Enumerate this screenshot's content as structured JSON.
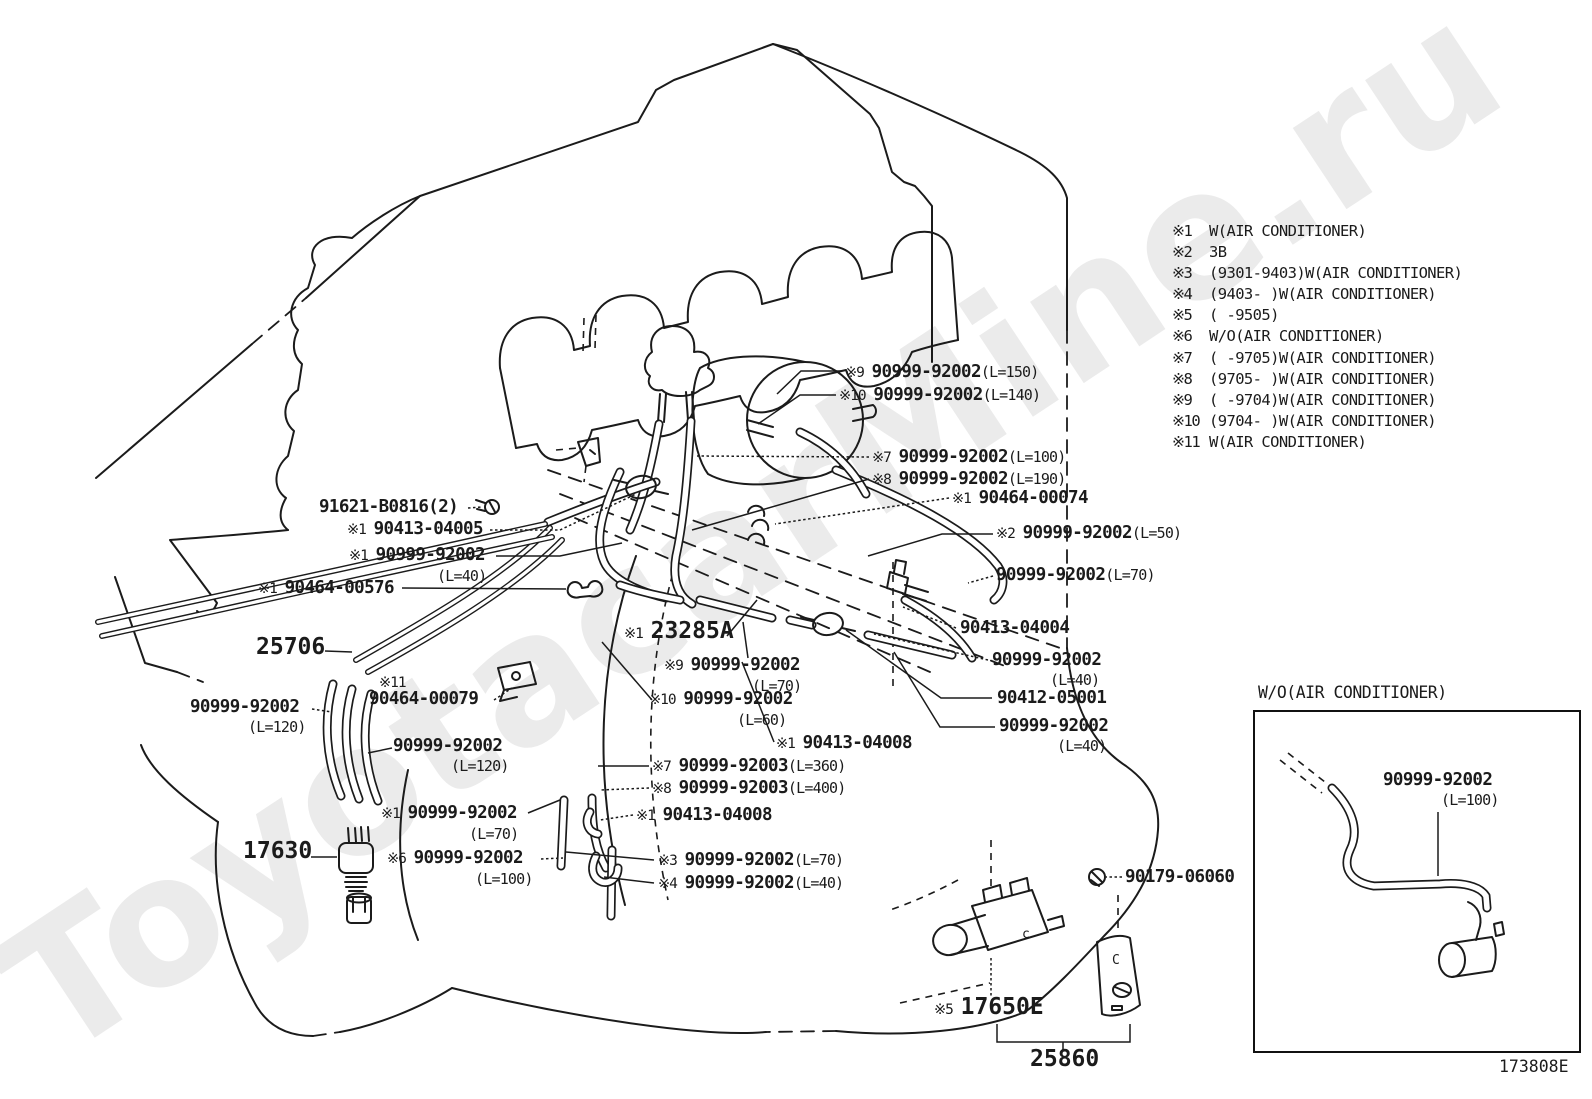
{
  "watermark": "ToyotacarMine.ru",
  "drawing_number": "173808E",
  "inset": {
    "title": "W/O(AIR CONDITIONER)"
  },
  "legend": {
    "items": [
      {
        "ref": "※1",
        "text": "W(AIR CONDITIONER)"
      },
      {
        "ref": "※2",
        "text": "3B"
      },
      {
        "ref": "※3",
        "text": "(9301-9403)W(AIR CONDITIONER)"
      },
      {
        "ref": "※4",
        "text": "(9403-    )W(AIR CONDITIONER)"
      },
      {
        "ref": "※5",
        "text": "(    -9505)"
      },
      {
        "ref": "※6",
        "text": "W/O(AIR CONDITIONER)"
      },
      {
        "ref": "※7",
        "text": "(    -9705)W(AIR CONDITIONER)"
      },
      {
        "ref": "※8",
        "text": "(9705-    )W(AIR CONDITIONER)"
      },
      {
        "ref": "※9",
        "text": "(    -9704)W(AIR CONDITIONER)"
      },
      {
        "ref": "※10",
        "text": "(9704-    )W(AIR CONDITIONER)"
      },
      {
        "ref": "※11",
        "text": "W(AIR CONDITIONER)"
      }
    ]
  },
  "callouts": [
    {
      "x": 845,
      "y": 362,
      "pre": "※9",
      "part": "90999-92002",
      "len": "(L=150)"
    },
    {
      "x": 839,
      "y": 385,
      "pre": "※10",
      "part": "90999-92002",
      "len": "(L=140)"
    },
    {
      "x": 872,
      "y": 447,
      "pre": "※7",
      "part": "90999-92002",
      "len": "(L=100)"
    },
    {
      "x": 872,
      "y": 469,
      "pre": "※8",
      "part": "90999-92002",
      "len": "(L=190)"
    },
    {
      "x": 952,
      "y": 488,
      "pre": "※1",
      "part": "90464-00074"
    },
    {
      "x": 996,
      "y": 523,
      "pre": "※2",
      "part": "90999-92002",
      "len": "(L=50)"
    },
    {
      "x": 996,
      "y": 565,
      "part": "90999-92002",
      "len": "(L=70)"
    },
    {
      "x": 960,
      "y": 618,
      "part": "90413-04004"
    },
    {
      "x": 992,
      "y": 650,
      "part": "90999-92002",
      "len2": "(L=40)"
    },
    {
      "x": 997,
      "y": 688,
      "part": "90412-05001"
    },
    {
      "x": 999,
      "y": 716,
      "part": "90999-92002",
      "len2": "(L=40)"
    },
    {
      "x": 624,
      "y": 621,
      "pre": "※1",
      "part": "23285A",
      "big": true
    },
    {
      "x": 664,
      "y": 655,
      "pre": "※9",
      "part": "90999-92002",
      "len2": "(L=70)"
    },
    {
      "x": 649,
      "y": 689,
      "pre": "※10",
      "part": "90999-92002",
      "len2": "(L=60)"
    },
    {
      "x": 776,
      "y": 733,
      "pre": "※1",
      "part": "90413-04008"
    },
    {
      "x": 652,
      "y": 756,
      "pre": "※7",
      "part": "90999-92003",
      "len": "(L=360)"
    },
    {
      "x": 652,
      "y": 778,
      "pre": "※8",
      "part": "90999-92003",
      "len": "(L=400)"
    },
    {
      "x": 636,
      "y": 805,
      "pre": "※1",
      "part": "90413-04008"
    },
    {
      "x": 658,
      "y": 850,
      "pre": "※3",
      "part": "90999-92002",
      "len": "(L=70)"
    },
    {
      "x": 658,
      "y": 873,
      "pre": "※4",
      "part": "90999-92002",
      "len": "(L=40)"
    },
    {
      "x": 319,
      "y": 497,
      "part": "91621-B0816(2)"
    },
    {
      "x": 347,
      "y": 519,
      "pre": "※1",
      "part": "90413-04005"
    },
    {
      "x": 349,
      "y": 545,
      "pre": "※1",
      "part": "90999-92002",
      "len2": "(L=40)"
    },
    {
      "x": 258,
      "y": 578,
      "pre": "※1",
      "part": "90464-00576"
    },
    {
      "x": 256,
      "y": 637,
      "part": "25706",
      "big": true
    },
    {
      "x": 379,
      "y": 672,
      "pre": "※11",
      "part": ""
    },
    {
      "x": 369,
      "y": 689,
      "part": "90464-00079"
    },
    {
      "x": 190,
      "y": 697,
      "part": "90999-92002",
      "len2": "(L=120)"
    },
    {
      "x": 393,
      "y": 736,
      "part": "90999-92002",
      "len2": "(L=120)"
    },
    {
      "x": 243,
      "y": 841,
      "part": "17630",
      "big": true
    },
    {
      "x": 381,
      "y": 803,
      "pre": "※1",
      "part": "90999-92002",
      "len2": "(L=70)"
    },
    {
      "x": 387,
      "y": 848,
      "pre": "※6",
      "part": "90999-92002",
      "len2": "(L=100)"
    },
    {
      "x": 1125,
      "y": 867,
      "part": "90179-06060"
    },
    {
      "x": 934,
      "y": 997,
      "pre": "※5",
      "part": "17650E",
      "big": true
    },
    {
      "x": 1030,
      "y": 1049,
      "part": "25860",
      "big": true
    },
    {
      "x": 1383,
      "y": 770,
      "part": "90999-92002",
      "len2": "(L=100)",
      "name": "inset-part-callout"
    }
  ]
}
